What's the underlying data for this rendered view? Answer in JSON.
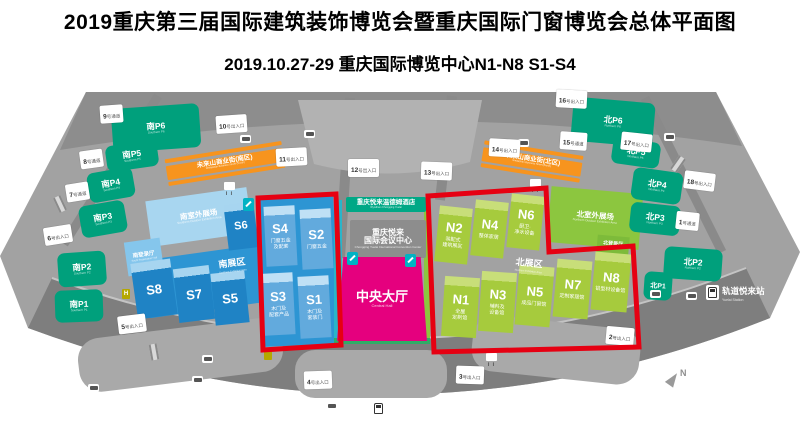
{
  "header": {
    "title": "2019重庆第三届国际建筑装饰博览会暨重庆国际门窗博览会总体平面图",
    "subtitle": "2019.10.27-29  重庆国际博览中心N1-N8 S1-S4"
  },
  "colors": {
    "highlight_red": "#e60012",
    "south_hall_blue": "#1f83c5",
    "south_hall_highlight_blue": "#62aadd",
    "north_hall_green": "#a6cb3d",
    "parking_teal": "#00a07c",
    "commercial_orange": "#f7941e",
    "central_hall_magenta": "#e5007e"
  },
  "south": {
    "zone_label": {
      "zh": "南展区",
      "en": "Southern Exhibition Area"
    },
    "outdoor": {
      "zh": "南室外展场",
      "en": "Southern Outdoor Exhibition Area"
    },
    "registration": {
      "zh": "南登录厅",
      "en": "South Registration Hall"
    },
    "halls": [
      {
        "id": "S8"
      },
      {
        "id": "S7"
      },
      {
        "id": "S6"
      },
      {
        "id": "S5"
      }
    ],
    "highlight_halls": [
      {
        "id": "S4",
        "sub": "门窗五金\n及配套"
      },
      {
        "id": "S2",
        "sub": "门窗五金"
      },
      {
        "id": "S3",
        "sub": "木门及\n配套产品"
      },
      {
        "id": "S1",
        "sub": "木门及\n套装门"
      }
    ]
  },
  "north": {
    "zone_label": {
      "zh": "北展区",
      "en": "Northern Exhibition Area"
    },
    "outdoor": {
      "zh": "北室外展场",
      "en": "Northern Outdoor Exhibition Area"
    },
    "registration": {
      "zh": "北登录厅",
      "en": "North Registration Hall"
    },
    "highlight_halls": [
      {
        "id": "N2",
        "sub": "装配式\n建筑展区"
      },
      {
        "id": "N4",
        "sub": "整体家居"
      },
      {
        "id": "N6",
        "sub": "厨卫·\n净水设备"
      },
      {
        "id": "N1",
        "sub": "全屋\n定制馆"
      },
      {
        "id": "N3",
        "sub": "辅料及\n设备馆"
      },
      {
        "id": "N5",
        "sub": "成品门窗馆"
      },
      {
        "id": "N7",
        "sub": "定制家居馆"
      },
      {
        "id": "N8",
        "sub": "铝型材设备馆"
      }
    ]
  },
  "center": {
    "hotel": {
      "zh": "重庆悦来温德姆酒店",
      "en": "Wyndham Chongqing Yuelai"
    },
    "convention": {
      "zh": "重庆悦来\n国际会议中心",
      "en": "Chongqing Yuelai International Convention Center"
    },
    "central_hall": {
      "zh": "中央大厅",
      "en": "Central Hall"
    }
  },
  "commercial": {
    "south": {
      "zh": "未来山商业街(南区)",
      "en": "Weilaishan Business Street (South)"
    },
    "north": {
      "zh": "未来山商业街(北区)",
      "en": "Weilaishan Business Street (North)"
    }
  },
  "parking": {
    "south": [
      {
        "label": "南P6",
        "en": "Southern P6"
      },
      {
        "label": "南P5",
        "en": "Southern P5"
      },
      {
        "label": "南P4",
        "en": "Southern P4"
      },
      {
        "label": "南P3",
        "en": "Southern P3"
      },
      {
        "label": "南P2",
        "en": "Southern P2"
      },
      {
        "label": "南P1",
        "en": "Southern P1"
      }
    ],
    "north": [
      {
        "label": "北P6",
        "en": "Northern P6"
      },
      {
        "label": "北P5",
        "en": "Northern P5"
      },
      {
        "label": "北P4",
        "en": "Northern P4"
      },
      {
        "label": "北P3",
        "en": "Northern P3"
      },
      {
        "label": "北P2",
        "en": "Northern P2"
      },
      {
        "label": "北P1",
        "en": "Northern P1"
      }
    ]
  },
  "gates": [
    {
      "num": "1",
      "suffix": "号通道"
    },
    {
      "num": "2",
      "suffix": "号出入口"
    },
    {
      "num": "3",
      "suffix": "号出入口"
    },
    {
      "num": "4",
      "suffix": "号出入口"
    },
    {
      "num": "5",
      "suffix": "号出入口"
    },
    {
      "num": "6",
      "suffix": "号出入口"
    },
    {
      "num": "7",
      "suffix": "号通道"
    },
    {
      "num": "8",
      "suffix": "号通道"
    },
    {
      "num": "9",
      "suffix": "号通道"
    },
    {
      "num": "10",
      "suffix": "号出入口"
    },
    {
      "num": "11",
      "suffix": "号出入口"
    },
    {
      "num": "12",
      "suffix": "号出入口"
    },
    {
      "num": "13",
      "suffix": "号出入口"
    },
    {
      "num": "14",
      "suffix": "号出入口"
    },
    {
      "num": "15",
      "suffix": "号通道"
    },
    {
      "num": "16",
      "suffix": "号出入口"
    },
    {
      "num": "17",
      "suffix": "号出入口"
    },
    {
      "num": "18",
      "suffix": "号出入口"
    }
  ],
  "metro": {
    "yuelai": {
      "zh": "轨道悦来站",
      "en": "Yuelai Station"
    },
    "expo": {
      "zh": "轨道国博中心站",
      "en": "Expo Station"
    }
  },
  "compass": {
    "label": "N"
  }
}
